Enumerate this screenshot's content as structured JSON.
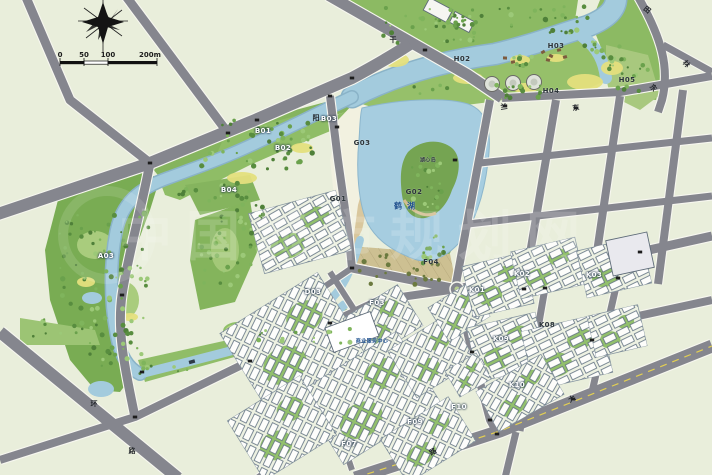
{
  "map": {
    "watermark": "中国城市规划网",
    "lake_name": "鹤湖",
    "scale_bar": {
      "labels": [
        "0",
        "50",
        "100",
        "200m"
      ]
    },
    "parcel_labels": [
      {
        "t": "B01",
        "x": 263,
        "y": 131,
        "c": "w"
      },
      {
        "t": "B02",
        "x": 283,
        "y": 148,
        "c": "w"
      },
      {
        "t": "B03",
        "x": 329,
        "y": 119,
        "c": "w"
      },
      {
        "t": "B04",
        "x": 229,
        "y": 190,
        "c": "w"
      },
      {
        "t": "A03",
        "x": 106,
        "y": 256,
        "c": "w"
      },
      {
        "t": "G01",
        "x": 338,
        "y": 199,
        "c": "d"
      },
      {
        "t": "G02",
        "x": 414,
        "y": 192,
        "c": "d"
      },
      {
        "t": "G03",
        "x": 362,
        "y": 143,
        "c": "d"
      },
      {
        "t": "H02",
        "x": 462,
        "y": 59,
        "c": "d"
      },
      {
        "t": "H03",
        "x": 556,
        "y": 46,
        "c": "d"
      },
      {
        "t": "H04",
        "x": 551,
        "y": 91,
        "c": "d"
      },
      {
        "t": "H05",
        "x": 627,
        "y": 80,
        "c": "d"
      },
      {
        "t": "D03",
        "x": 313,
        "y": 292,
        "c": "w"
      },
      {
        "t": "F03",
        "x": 377,
        "y": 303,
        "c": "w"
      },
      {
        "t": "F04",
        "x": 431,
        "y": 262,
        "c": "d"
      },
      {
        "t": "F07",
        "x": 349,
        "y": 444,
        "c": "w"
      },
      {
        "t": "F09",
        "x": 415,
        "y": 422,
        "c": "w"
      },
      {
        "t": "F10",
        "x": 459,
        "y": 407,
        "c": "w"
      },
      {
        "t": "K01",
        "x": 477,
        "y": 290,
        "c": "w"
      },
      {
        "t": "K02",
        "x": 522,
        "y": 274,
        "c": "w"
      },
      {
        "t": "K03",
        "x": 594,
        "y": 275,
        "c": "w"
      },
      {
        "t": "K08",
        "x": 547,
        "y": 325,
        "c": "d"
      },
      {
        "t": "K09",
        "x": 501,
        "y": 339,
        "c": "w"
      },
      {
        "t": "K10",
        "x": 517,
        "y": 385,
        "c": "w"
      }
    ],
    "poi_labels": [
      {
        "t": "鹤湖",
        "x": 407,
        "y": 206,
        "c": "blue",
        "s": 8,
        "ls": 5
      },
      {
        "t": "湖心岛",
        "x": 428,
        "y": 160,
        "c": "dk",
        "s": 5
      },
      {
        "t": "商业服务中心",
        "x": 372,
        "y": 341,
        "c": "blue",
        "s": 5
      }
    ],
    "road_labels": [
      {
        "t": "干",
        "x": 393,
        "y": 40,
        "r": 0
      },
      {
        "t": "阳",
        "x": 316,
        "y": 118,
        "r": 0
      },
      {
        "t": "田",
        "x": 647,
        "y": 10,
        "r": 40
      },
      {
        "t": "林",
        "x": 686,
        "y": 64,
        "r": 50
      },
      {
        "t": "东",
        "x": 653,
        "y": 88,
        "r": 50
      },
      {
        "t": "兰",
        "x": 504,
        "y": 107,
        "r": -8
      },
      {
        "t": "东",
        "x": 576,
        "y": 108,
        "r": -8
      },
      {
        "t": "环",
        "x": 94,
        "y": 404,
        "r": 0
      },
      {
        "t": "路",
        "x": 132,
        "y": 451,
        "r": 0
      },
      {
        "t": "大",
        "x": 572,
        "y": 399,
        "r": -30
      },
      {
        "t": "路",
        "x": 433,
        "y": 452,
        "r": -30
      }
    ]
  }
}
